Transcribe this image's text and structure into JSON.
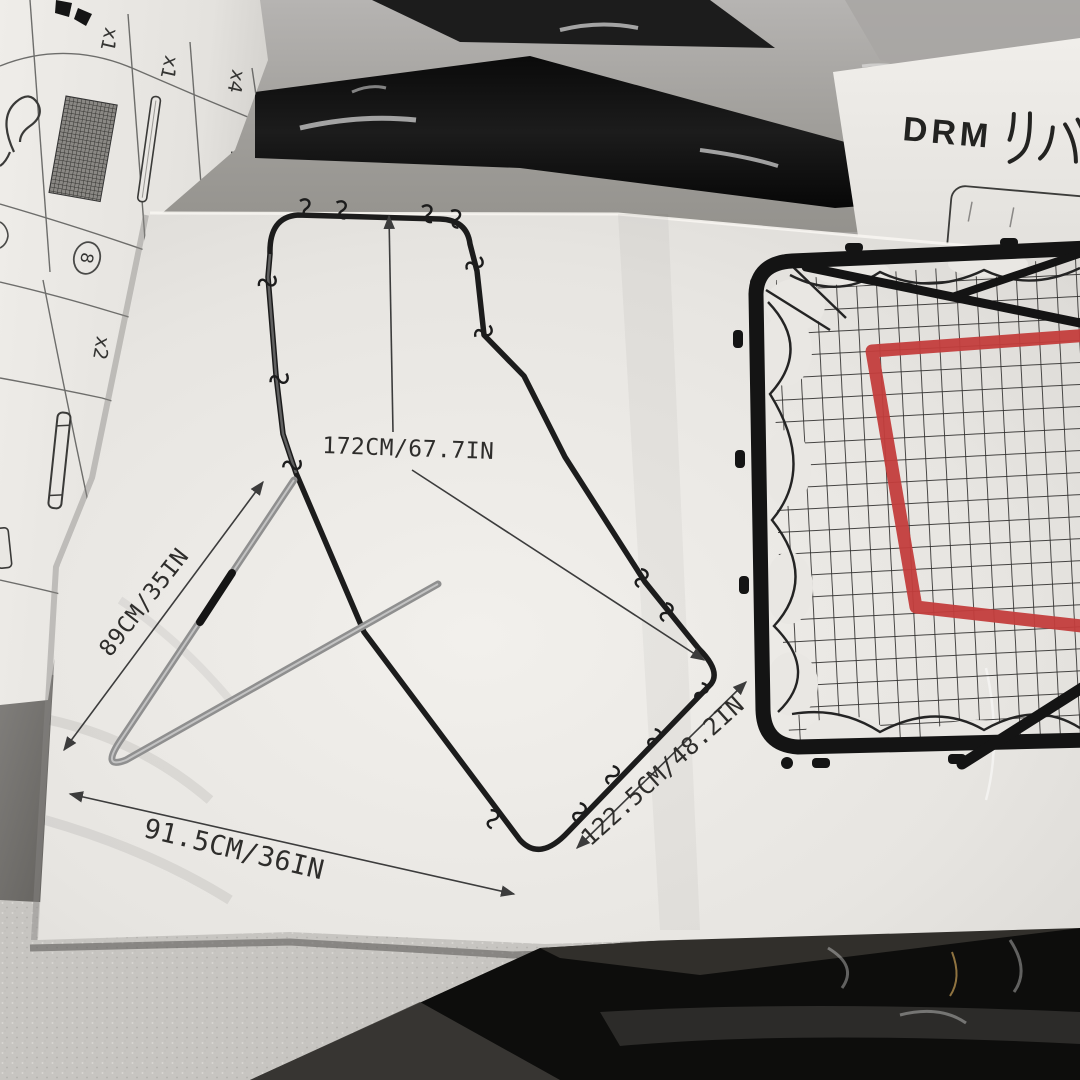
{
  "parts_sheet": {
    "quantities": [
      "x1",
      "x1",
      "x4",
      "x2"
    ],
    "circled_number": "8",
    "part_icons": [
      "loop-cord-icon",
      "net-swatch-icon",
      "rod-icon",
      "j-hook-icon",
      "tube-pin-icon",
      "rod-partial-icon"
    ]
  },
  "drm_sheet": {
    "title_latin": "DRM",
    "title_kana": "リバ"
  },
  "assembly_diagram": {
    "dim_height": "172CM/67.7IN",
    "dim_depth": "89CM/35IN",
    "dim_base_width": "91.5CM/36IN",
    "dim_front_width": "122.5CM/48.2IN"
  },
  "net_photo": {
    "frame_color": "#141414",
    "net_color": "#2e2d2c",
    "target_color": "#c33d3c"
  },
  "scene_colors": {
    "paper": "#e9e7e3",
    "table_gray": "#a3a19e",
    "pole_black": "#0d0d0c",
    "foam_gray": "#c7c5c1"
  }
}
